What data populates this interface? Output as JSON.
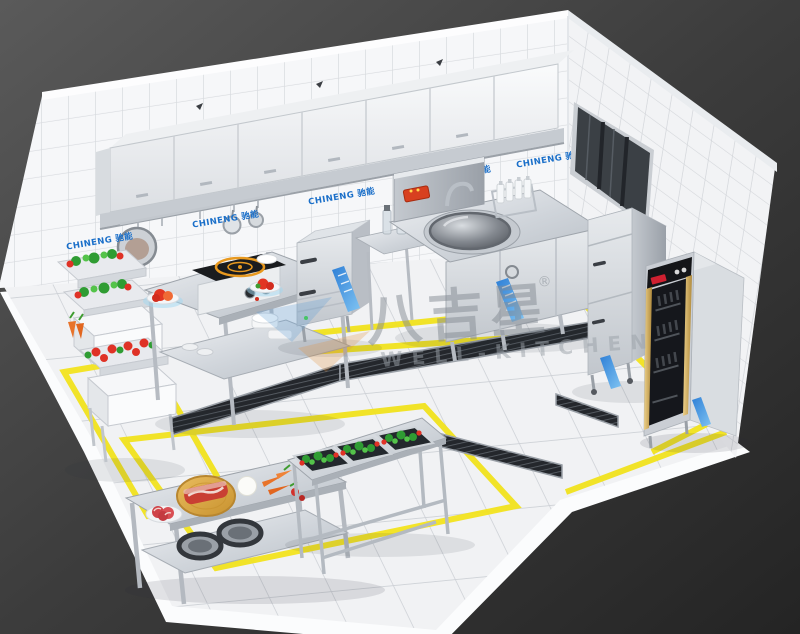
{
  "watermark": {
    "logo_text": "八吉星",
    "registered_mark": "®",
    "subtitle": "WELL-KITCHEN"
  },
  "brand": {
    "wall_label": "CHINENG 驰能"
  },
  "palette": {
    "background_dark": "#262626",
    "background_light": "#585858",
    "tile_white": "#f6f7f8",
    "grout_gray": "#d6d9dd",
    "stainless_steel": "#c9ced4",
    "safety_yellow": "#f2e31e",
    "brand_blue": "#1a6fc9",
    "watermark_gray": "#878e96",
    "veg_green": "#3aa33a",
    "veg_red": "#df3226",
    "wood_tan": "#d9a63f",
    "glass_black": "#17191d",
    "gold_trim": "#c9a24e",
    "induction_orange": "#e8991f"
  }
}
